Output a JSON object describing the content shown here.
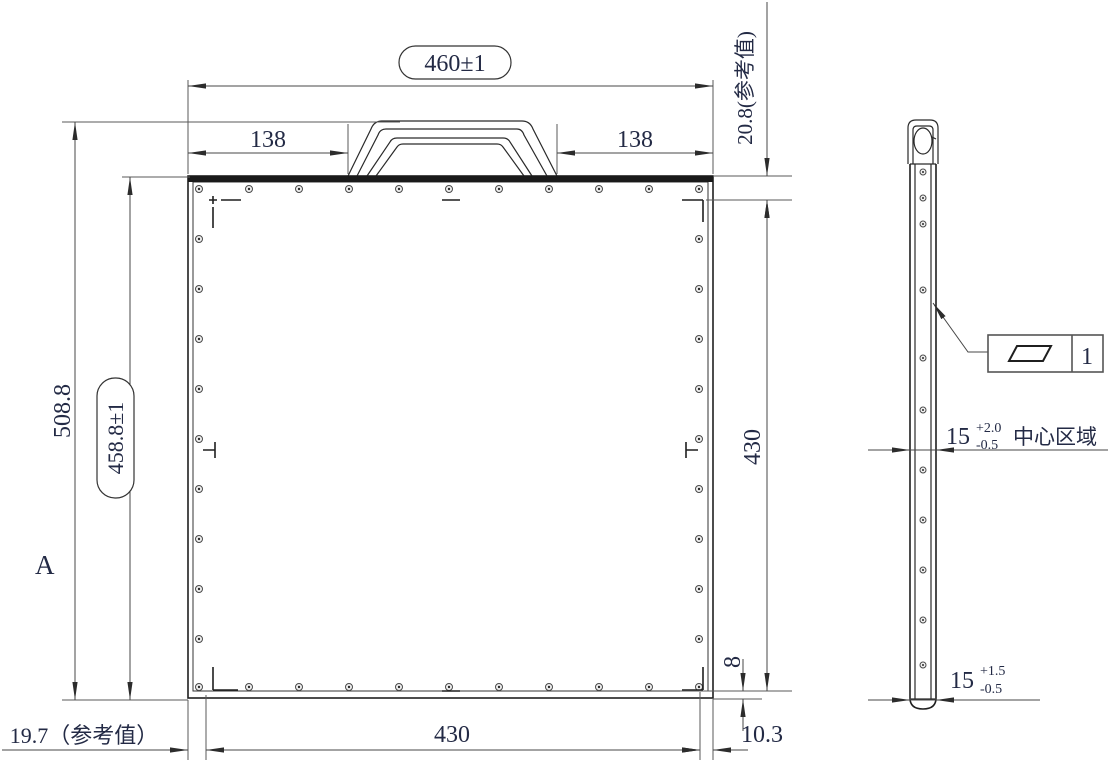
{
  "colors": {
    "outline": "#1f1f1f",
    "dim_line": "#474747",
    "text": "#232a45",
    "top_edge_fill": "#1a1a1a",
    "background": "#ffffff"
  },
  "front_view": {
    "overall_width": "460±1",
    "handle_left_offset": "138",
    "handle_right_offset": "138",
    "top_edge_height_ref": "20.8(参考值)",
    "overall_height": "508.8",
    "frame_height": "458.8±1",
    "section_label": "A",
    "right_inner_span": "430",
    "bottom_inner_span": "430",
    "bottom_edge_width": "8",
    "bottom_right_offset": "10.3",
    "bottom_left_offset_ref": "19.7（参考值）"
  },
  "side_view": {
    "flatness_frame": {
      "symbol_icon": "parallelogram-flatness-icon",
      "tolerance": "1"
    },
    "center_thickness": {
      "nominal": "15",
      "upper_tol": "+2.0",
      "lower_tol": "-0.5",
      "zone_note": "中心区域"
    },
    "edge_thickness": {
      "nominal": "15",
      "upper_tol": "+1.5",
      "lower_tol": "-0.5"
    }
  }
}
